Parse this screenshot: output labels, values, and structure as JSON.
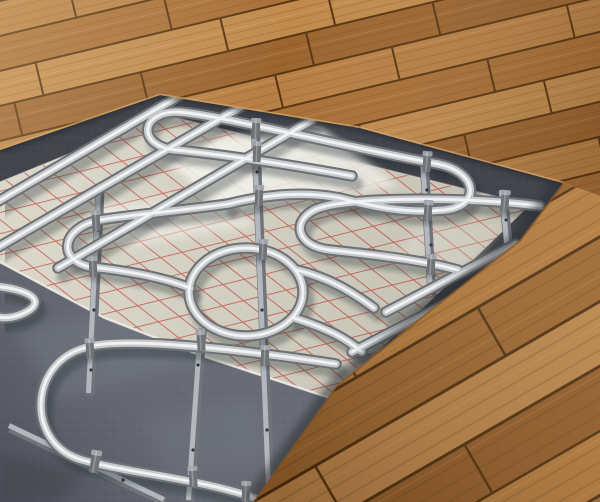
{
  "scene": {
    "aria_label": "3D rendering of an underfloor heating system: wooden floorboards cut away to reveal serpentine metal heating pipes fixed with clips to mounting rails on silver insulation foil printed with a red grid, laid over a dark concrete subfloor",
    "subject": "Underfloor heating installation cutaway",
    "style": "photorealistic 3D render, isometric perspective",
    "visible_text": ""
  },
  "objects": [
    {
      "name": "hardwood-floor",
      "desc": "Diagonal brown wooden planks covering the top and right of the scene"
    },
    {
      "name": "cutaway-opening",
      "desc": "Exposed section of the floor build-up"
    },
    {
      "name": "underlay-border",
      "desc": "Dark speckled underlay band bordering the opening under the plank edges"
    },
    {
      "name": "insulation-foil",
      "desc": "Light silver-beige insulation sheet printed with a red installation grid"
    },
    {
      "name": "red-grid",
      "desc": "Red diamond grid printed on the foil"
    },
    {
      "name": "heating-pipes",
      "desc": "Polished metal heating pipes laid in serpentine hairpin loops with one circular loop"
    },
    {
      "name": "mounting-rails",
      "desc": "Flat metal fixing rails with screw holes running across the pipe runs"
    },
    {
      "name": "pipe-clips",
      "desc": "Small metal saddle clips fastening the pipes to the rails"
    },
    {
      "name": "concrete-subfloor",
      "desc": "Dark blue-grey speckled screed exposed in the foreground"
    }
  ],
  "palette": {
    "wood_light": "#c4935c",
    "wood_mid": "#aa7038",
    "wood_dark": "#8a5526",
    "wood_seam": "#573510",
    "wood_seam_right": "#46290c",
    "wood_edge_face": "#d2a76b",
    "wood_edge_face_right": "#7c4f22",
    "wood_rows_top": [
      "#b87f44",
      "#a96f36",
      "#c08a4c",
      "#9c6530"
    ],
    "wood_rows_right": [
      "#ad753b",
      "#97622e",
      "#b7824a",
      "#8d5828"
    ],
    "underlay": "#42454d",
    "underlay_shadow": "#26282e",
    "concrete": "#5d616c",
    "concrete_light": "#767c89",
    "foil": "#d7d4c6",
    "foil_bright": "#fdfcf5",
    "foil_edge": "#efede1",
    "grid_red": "#c24a3e",
    "pipe_dark": "#6d7074",
    "pipe_mid": "#c6c8ca",
    "pipe_light": "#f0f2f3",
    "pipe_shadow": "rgba(33,36,46,0.32)",
    "rail": "#70747a",
    "rail_light": "#b3b8bf",
    "clip": "#6f7277",
    "clip_top": "#a0a3a9"
  }
}
